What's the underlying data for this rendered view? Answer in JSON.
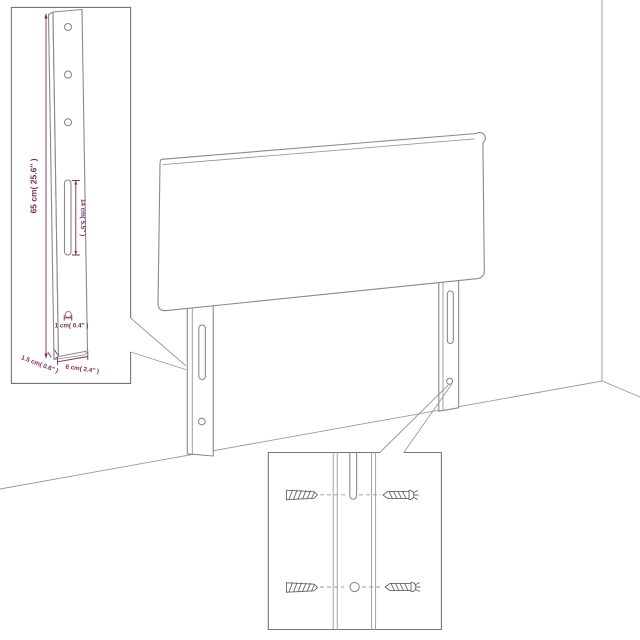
{
  "diagram": {
    "kind": "headboard-assembly-dimension-diagram",
    "dimensions": {
      "height": "65 cm( 25.6″ )",
      "slot_length": "14 cm( 5.5″ )",
      "pilot_hole": "1 cm( 0.4″ )",
      "thickness": "1.5 cm( 0.6″ )",
      "width": "6 cm( 2.4″ )"
    },
    "icons": {
      "wall_plug": "wall-plug-icon",
      "screw": "screw-icon"
    },
    "colors": {
      "dimension_text": "#7c2b5d",
      "line_gray": "#8a8a8a",
      "border_gray": "#757575",
      "background": "#ffffff"
    }
  }
}
